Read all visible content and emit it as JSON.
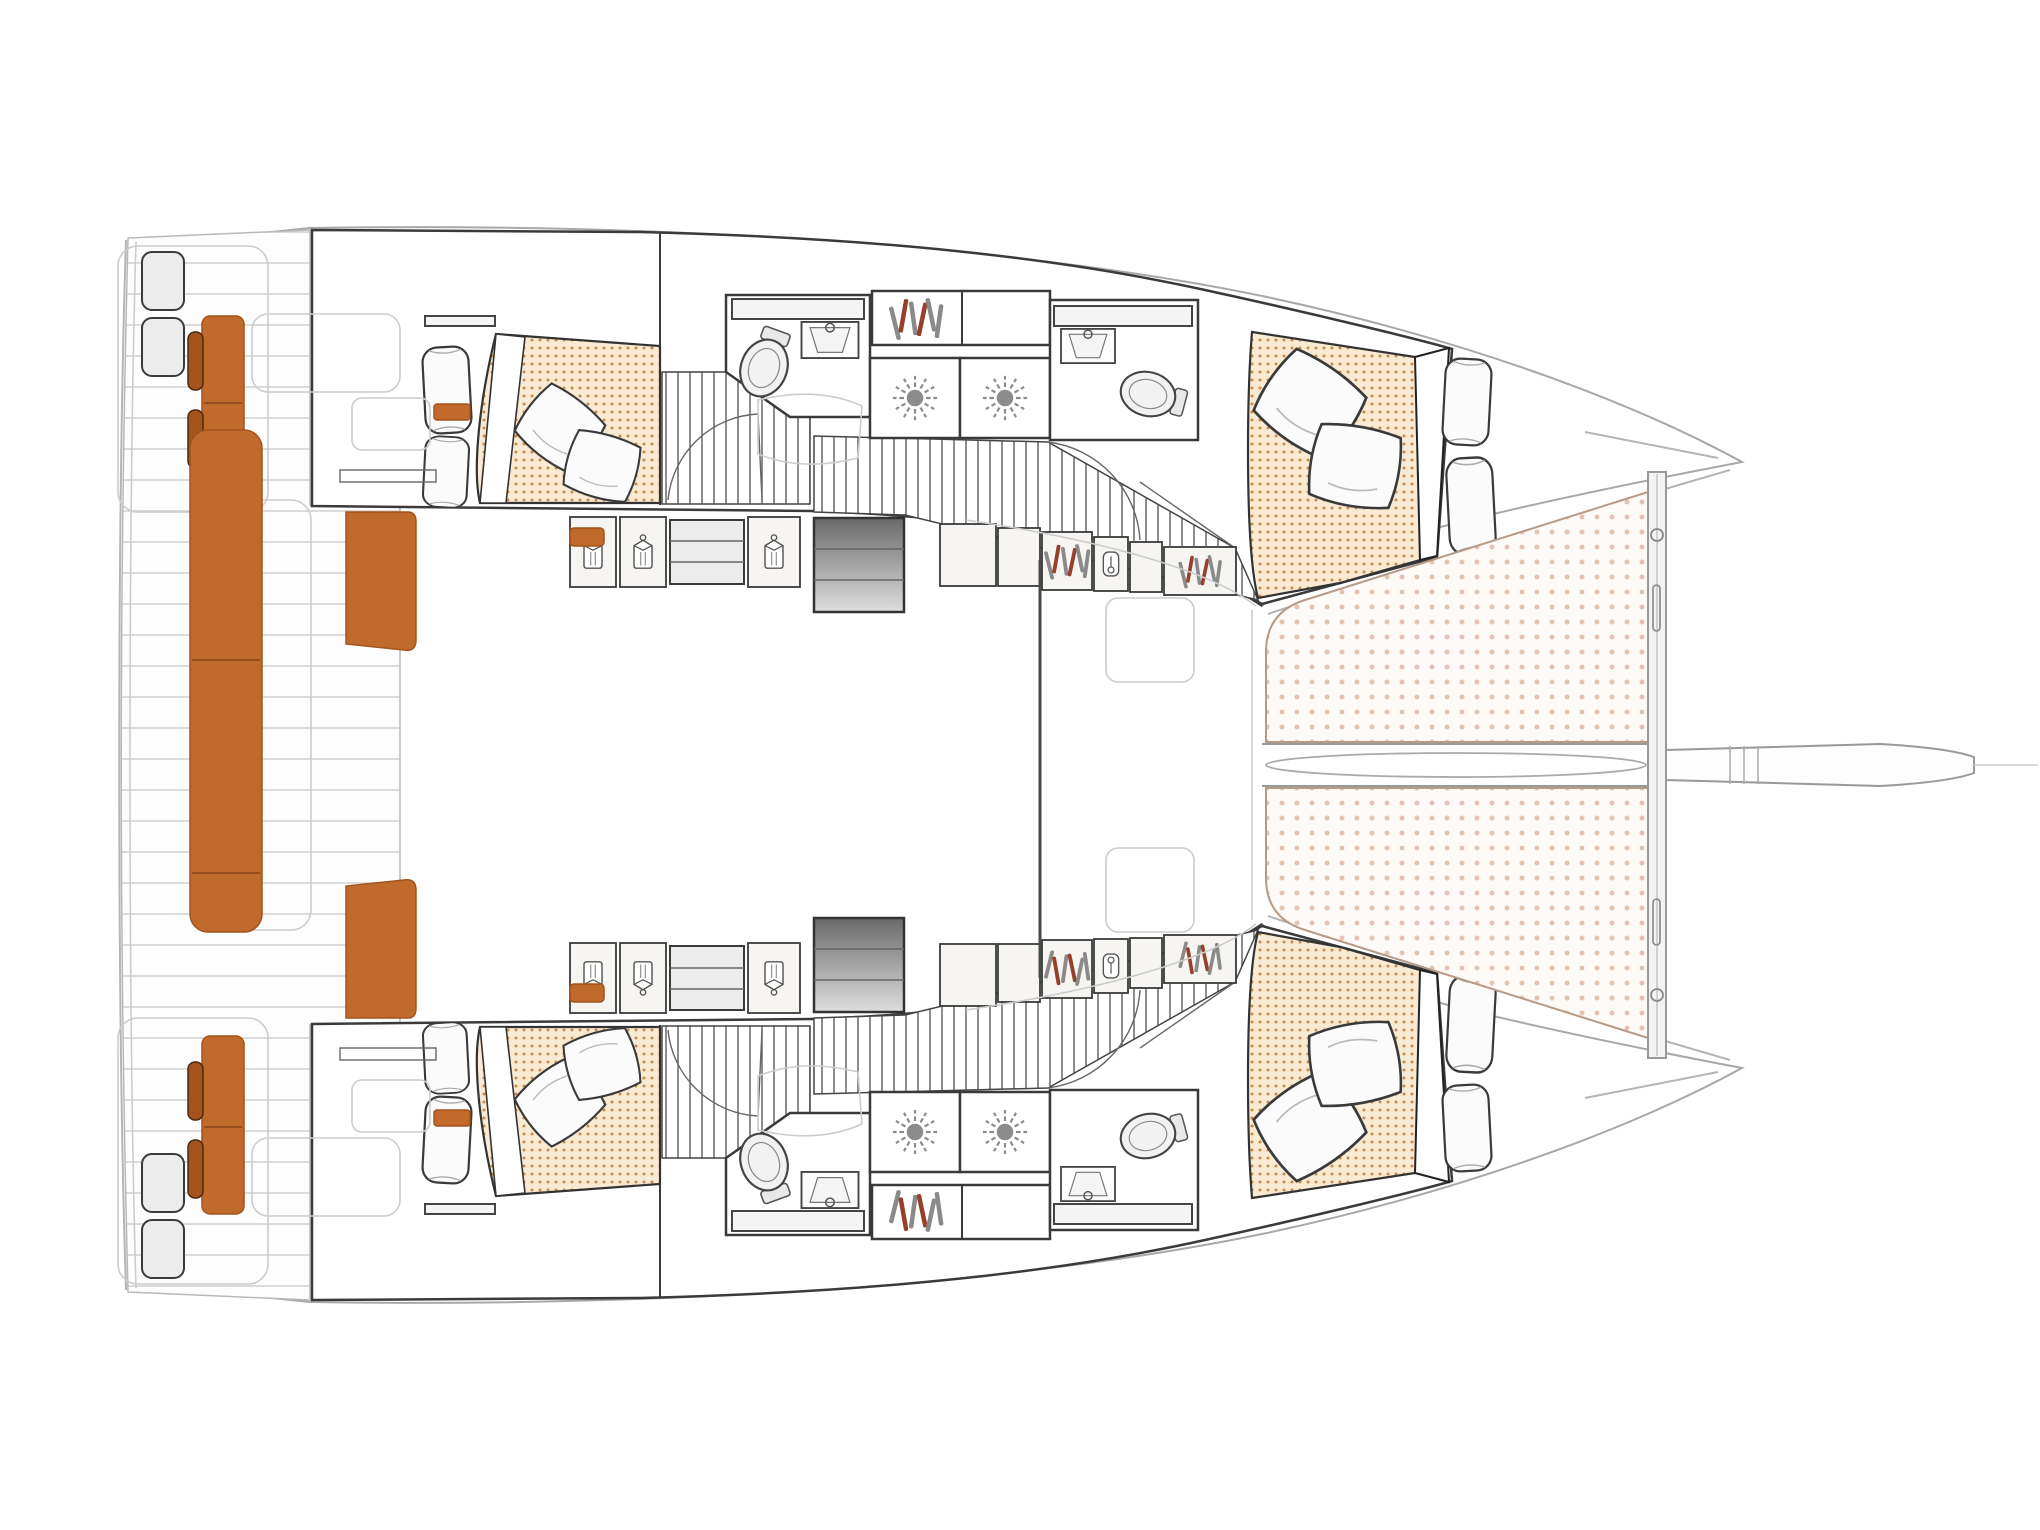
{
  "page": {
    "title": "Catamaran sailing yacht — interior accommodation floor plan (top view, bow to the right)"
  },
  "colors": {
    "accent_orange": "#C06A2C",
    "accent_orange_dark": "#A4531C",
    "outline_dark": "#3A3A3A",
    "outline_light": "#B5B5B5",
    "plank_line": "#D0D0D0",
    "bed_dot_bg": "#F8EAD3",
    "bed_dot": "#CE8A4A",
    "tramp_bg": "#FDFAF8",
    "tramp_dot": "#E5C3B2",
    "stair_dark": "#6A6A6A",
    "stair_light": "#DEDEDE",
    "hanger_red": "#96402A",
    "glyph_gray": "#8C8C8C",
    "locker_fill": "#F6F5F2"
  },
  "boat": {
    "type": "catamaran floor plan",
    "view": "overhead deck and accommodation plan",
    "orientation": "bow facing right, stern (cockpit and swim platforms) on the left",
    "hulls": [
      {
        "id": "hull-top",
        "rooms": [
          "aft cabin with angled double bed, dotted duvet, two throw pillows, two side pillows, shelf, orange bedside accent",
          "aft head with toilet, washbasin and vanity",
          "two shower compartments with shower-rose symbols",
          "wardrobe locker with clothes hangers",
          "slatted corridor stairs with door swing arcs",
          "companionway steps down from saloon (grey gradient)",
          "storage lockers with hanger and garment icons",
          "forward head with vanity, washbasin and toilet",
          "forward cabin with angled double bed, dotted duvet, two throw pillows, two hull-side pillows and wedge door"
        ]
      },
      {
        "id": "hull-bottom",
        "rooms": [
          "mirror image of top hull: aft cabin, aft head, showers, wardrobes, companionway, forward head, forward cabin"
        ]
      }
    ],
    "center_deck": [
      "stern swim platform steps on each hull",
      "transom bench with orange cushions and two orange backrest pads per hull",
      "long central orange cockpit lounge bench",
      "two orange cockpit side seats",
      "teak plank cockpit decking",
      "open saloon area (undrawn, white)",
      "mast support beam line",
      "two faint saloon front windows",
      "twin bow trampolines with dotted netting",
      "central spar channel with elongated sleeve",
      "forward crossbeam with fitting circles and slots",
      "tapered bowsprit with tick marks and faint forestay line"
    ]
  }
}
